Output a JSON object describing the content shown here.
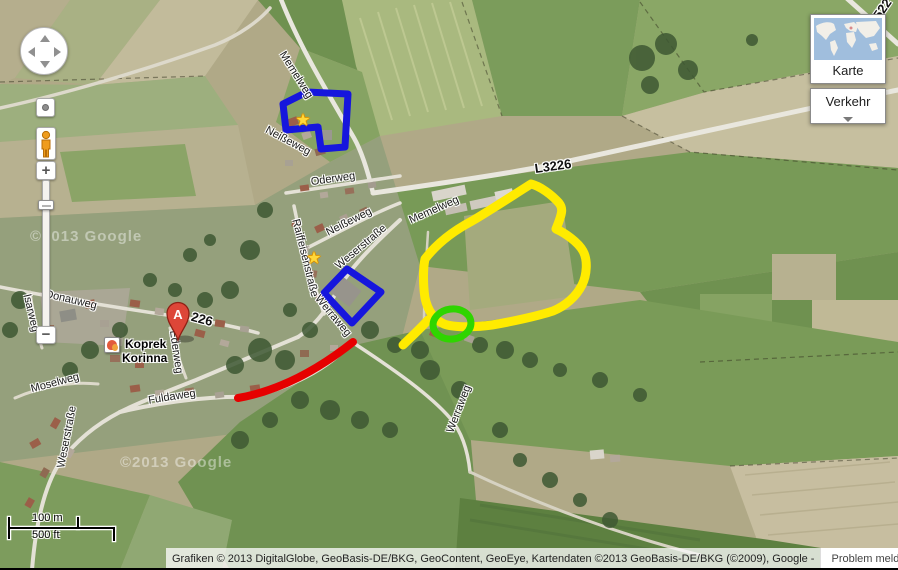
{
  "map": {
    "street_labels": [
      {
        "text": "Memelweg",
        "x": 296,
        "y": 75,
        "rot": 58,
        "ref": false
      },
      {
        "text": "Neißeweg",
        "x": 288,
        "y": 141,
        "rot": 28,
        "ref": false
      },
      {
        "text": "Oderweg",
        "x": 333,
        "y": 179,
        "rot": -8,
        "ref": false
      },
      {
        "text": "Neißeweg",
        "x": 349,
        "y": 222,
        "rot": -27,
        "ref": false
      },
      {
        "text": "Raiffeisenstraße",
        "x": 305,
        "y": 258,
        "rot": 76,
        "ref": false
      },
      {
        "text": "Weserstraße",
        "x": 361,
        "y": 247,
        "rot": -40,
        "ref": false
      },
      {
        "text": "Memelweg",
        "x": 434,
        "y": 210,
        "rot": -24,
        "ref": false
      },
      {
        "text": "L3226",
        "x": 553,
        "y": 166,
        "rot": -8,
        "ref": true
      },
      {
        "text": "L522",
        "x": 880,
        "y": 12,
        "rot": -55,
        "ref": true
      },
      {
        "text": "Donauweg",
        "x": 71,
        "y": 300,
        "rot": 13,
        "ref": false
      },
      {
        "text": "Isarweg",
        "x": 31,
        "y": 313,
        "rot": 77,
        "ref": false
      },
      {
        "text": "226",
        "x": 202,
        "y": 319,
        "rot": 15,
        "ref": true
      },
      {
        "text": "Ederweg",
        "x": 176,
        "y": 352,
        "rot": 82,
        "ref": false
      },
      {
        "text": "Moselweg",
        "x": 55,
        "y": 383,
        "rot": -15,
        "ref": false
      },
      {
        "text": "Fuldaweg",
        "x": 172,
        "y": 397,
        "rot": -9,
        "ref": false
      },
      {
        "text": "Weserstraße",
        "x": 67,
        "y": 437,
        "rot": -79,
        "ref": false
      },
      {
        "text": "Werraweg",
        "x": 333,
        "y": 316,
        "rot": 50,
        "ref": false
      },
      {
        "text": "Werraweg",
        "x": 459,
        "y": 409,
        "rot": -69,
        "ref": false
      }
    ],
    "stars": [
      {
        "x": 303,
        "y": 120
      },
      {
        "x": 314,
        "y": 258
      }
    ],
    "marker": {
      "label": "A"
    },
    "place_label": {
      "line1": "Koprek",
      "line2": "Korinna"
    },
    "watermark": "©2013 Google",
    "annotation_colors": {
      "blue": "#1616dd",
      "yellow": "#ffeb00",
      "green": "#2fd500",
      "red": "#e60000"
    }
  },
  "controls": {
    "zoom_in": "+",
    "zoom_out": "−"
  },
  "layers_panel": {
    "karte": "Karte",
    "verkehr": "Verkehr"
  },
  "scale_bar": {
    "metric": "100 m",
    "imperial": "500 ft"
  },
  "attribution": {
    "text": "Grafiken © 2013 DigitalGlobe, GeoBasis-DE/BKG, GeoContent, GeoEye, Kartendaten ©2013 GeoBasis-DE/BKG (©2009), Google -",
    "report": "Problem melden"
  }
}
